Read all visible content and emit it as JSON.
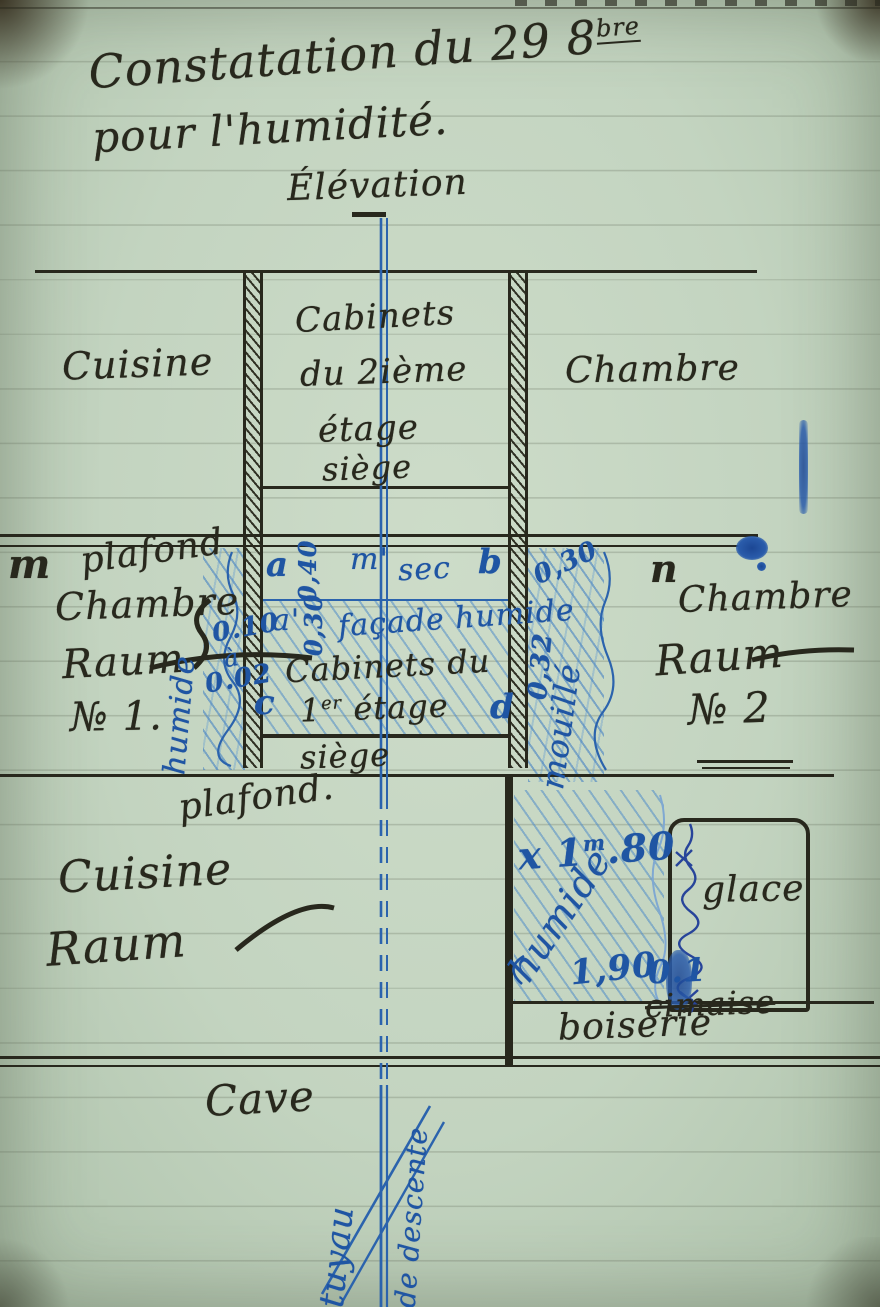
{
  "title": {
    "line1_pre": "Constatation du 29 8",
    "line1_sup": "bre",
    "line2": "pour l'humidité.",
    "drawing_label": "Élévation"
  },
  "floor2": {
    "room_left": "Cuisine",
    "room_right": "Chambre",
    "closet": {
      "line1": "Cabinets",
      "line2": "du 2ième",
      "line3": "étage",
      "line4": "siège"
    }
  },
  "floor1": {
    "marker_left": "m",
    "ceiling_left": "plafond",
    "room_left": {
      "line1": "Chambre",
      "line2": "Raum",
      "line3": "№ 1."
    },
    "left_wall": {
      "state": "humide",
      "value_top": "0.10",
      "sep": "à",
      "value_bottom": "0.02"
    },
    "points": {
      "a": "a",
      "a_prime": "a'",
      "b": "b",
      "c": "c",
      "d": "d",
      "m_prime": "m'",
      "n": "n"
    },
    "dry_label": "sec",
    "height_upper": "0,40",
    "height_lower": "0,30",
    "facade_label": "façade humide",
    "closet": {
      "line1": "Cabinets du",
      "line2_pre": "1",
      "line2_sup": "er",
      "line2_post": " étage",
      "line3": "siège"
    },
    "right_wall": {
      "value_top": "0,30",
      "value_mid": "0,32",
      "state": "mouillé"
    },
    "room_right": {
      "line1": "Chambre",
      "line2": "Raum",
      "line3": "№ 2"
    },
    "ceiling_label": "plafond."
  },
  "floor0": {
    "room_left": {
      "line1": "Cuisine",
      "line2": "Raum"
    },
    "wet": {
      "h_top_pre": "x 1",
      "h_top_sup": "m",
      "h_top_post": ".80",
      "state": "humide",
      "h_bottom": "1,90",
      "value_right": "0.1"
    },
    "mirror": "glace",
    "crossed_out": "cimaise",
    "paneling": "boiserie"
  },
  "basement": {
    "room": "Cave",
    "pipe_word1": "tuyau",
    "pipe_word2": "de descente"
  },
  "colors": {
    "paper": "#c3d4c0",
    "ink": "#28281d",
    "blue": "#1f55a3",
    "blue_light": "#7fa8d2"
  }
}
